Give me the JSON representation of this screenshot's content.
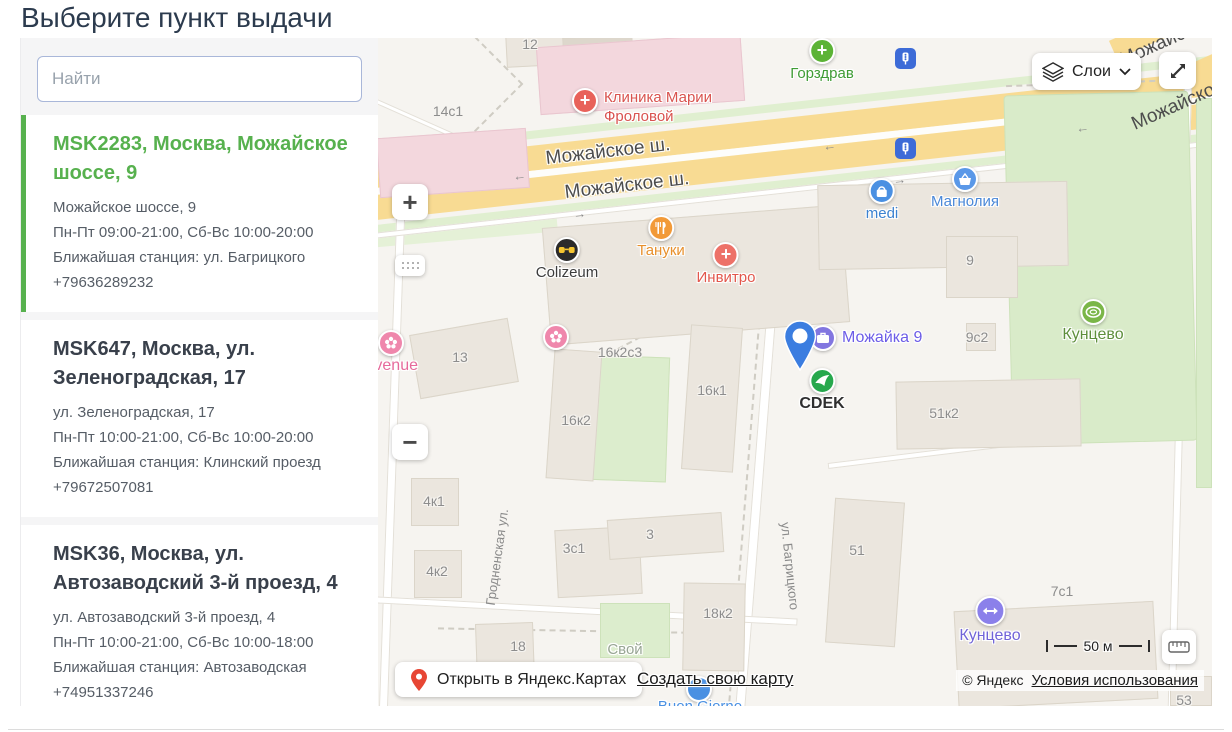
{
  "page": {
    "title": "Выберите пункт выдачи"
  },
  "sidebar": {
    "search_placeholder": "Найти",
    "points": [
      {
        "title": "MSK2283, Москва, Можайское шоссе, 9",
        "address": "Можайское шоссе, 9",
        "hours": "Пн-Пт 09:00-21:00, Сб-Вс 10:00-20:00",
        "station": "Ближайшая станция: ул. Багрицкого",
        "phone": "+79636289232",
        "selected": true
      },
      {
        "title": "MSK647, Москва, ул. Зеленоградская, 17",
        "address": "ул. Зеленоградская, 17",
        "hours": "Пн-Пт 10:00-21:00, Сб-Вс 10:00-20:00",
        "station": "Ближайшая станция: Клинский проезд",
        "phone": "+79672507081",
        "selected": false
      },
      {
        "title": "MSK36, Москва, ул. Автозаводский 3-й проезд, 4",
        "address": "ул. Автозаводский 3-й проезд, 4",
        "hours": "Пн-Пт 10:00-21:00, Сб-Вс 10:00-18:00",
        "station": "Ближайшая станция: Автозаводская",
        "phone": "+74951337246",
        "selected": false
      }
    ]
  },
  "map": {
    "controls": {
      "layers": "Слои",
      "zoom_in": "+",
      "zoom_out": "−",
      "open_in_yandex": "Открыть в Яндекс.Картах",
      "create_map": "Создать свою карту",
      "scale": "50 м",
      "copyright": "© Яндекс",
      "terms": "Условия использования"
    },
    "roads": {
      "mozhayskoe_1": "Можайское ш.",
      "mozhayskoe_2": "Можайское ш.",
      "corner_1": "Можайское ш.",
      "corner_2": "Можайское ш.",
      "grodnenskaya": "Гродненская ул.",
      "bagritskogo": "ул. Багрицкого"
    },
    "arrows": {
      "left": "←",
      "right": "→"
    },
    "pois": {
      "gorzdrav": "Горздрав",
      "clinic": "Клиника Марии Фроловой",
      "tanuki": "Тануки",
      "invitro": "Инвитро",
      "colizeum": "Colizeum",
      "medi": "medi",
      "magnolia": "Магнолия",
      "avenue": "Avenue",
      "mozhayka9": "Можайка 9",
      "cdek": "CDEK",
      "kuntsevo_park": "Кунцево",
      "kuntsevo_station": "Кунцево",
      "svoy": "Свой",
      "buon_giorno": "Buon Giorno"
    },
    "buildings": {
      "b12": "12",
      "b14s1": "14с1",
      "b13": "13",
      "b16k2s3": "16к2с3",
      "b16k2": "16к2",
      "b16k1": "16к1",
      "b9": "9",
      "b9s2": "9с2",
      "b51k2": "51к2",
      "b51": "51",
      "b4k1": "4к1",
      "b4k2": "4к2",
      "b3s1": "3с1",
      "b3": "3",
      "b18k2": "18к2",
      "b18": "18",
      "b7s1": "7с1",
      "b53": "53"
    }
  },
  "colors": {
    "accent_green": "#57b14e",
    "cdek_green": "#27a84d",
    "pin_blue": "#3b7de0",
    "poi_red": "#e2574c",
    "poi_blue": "#4a90e2",
    "poi_purple": "#7b6fe0",
    "road_yellow": "#f8db93"
  }
}
